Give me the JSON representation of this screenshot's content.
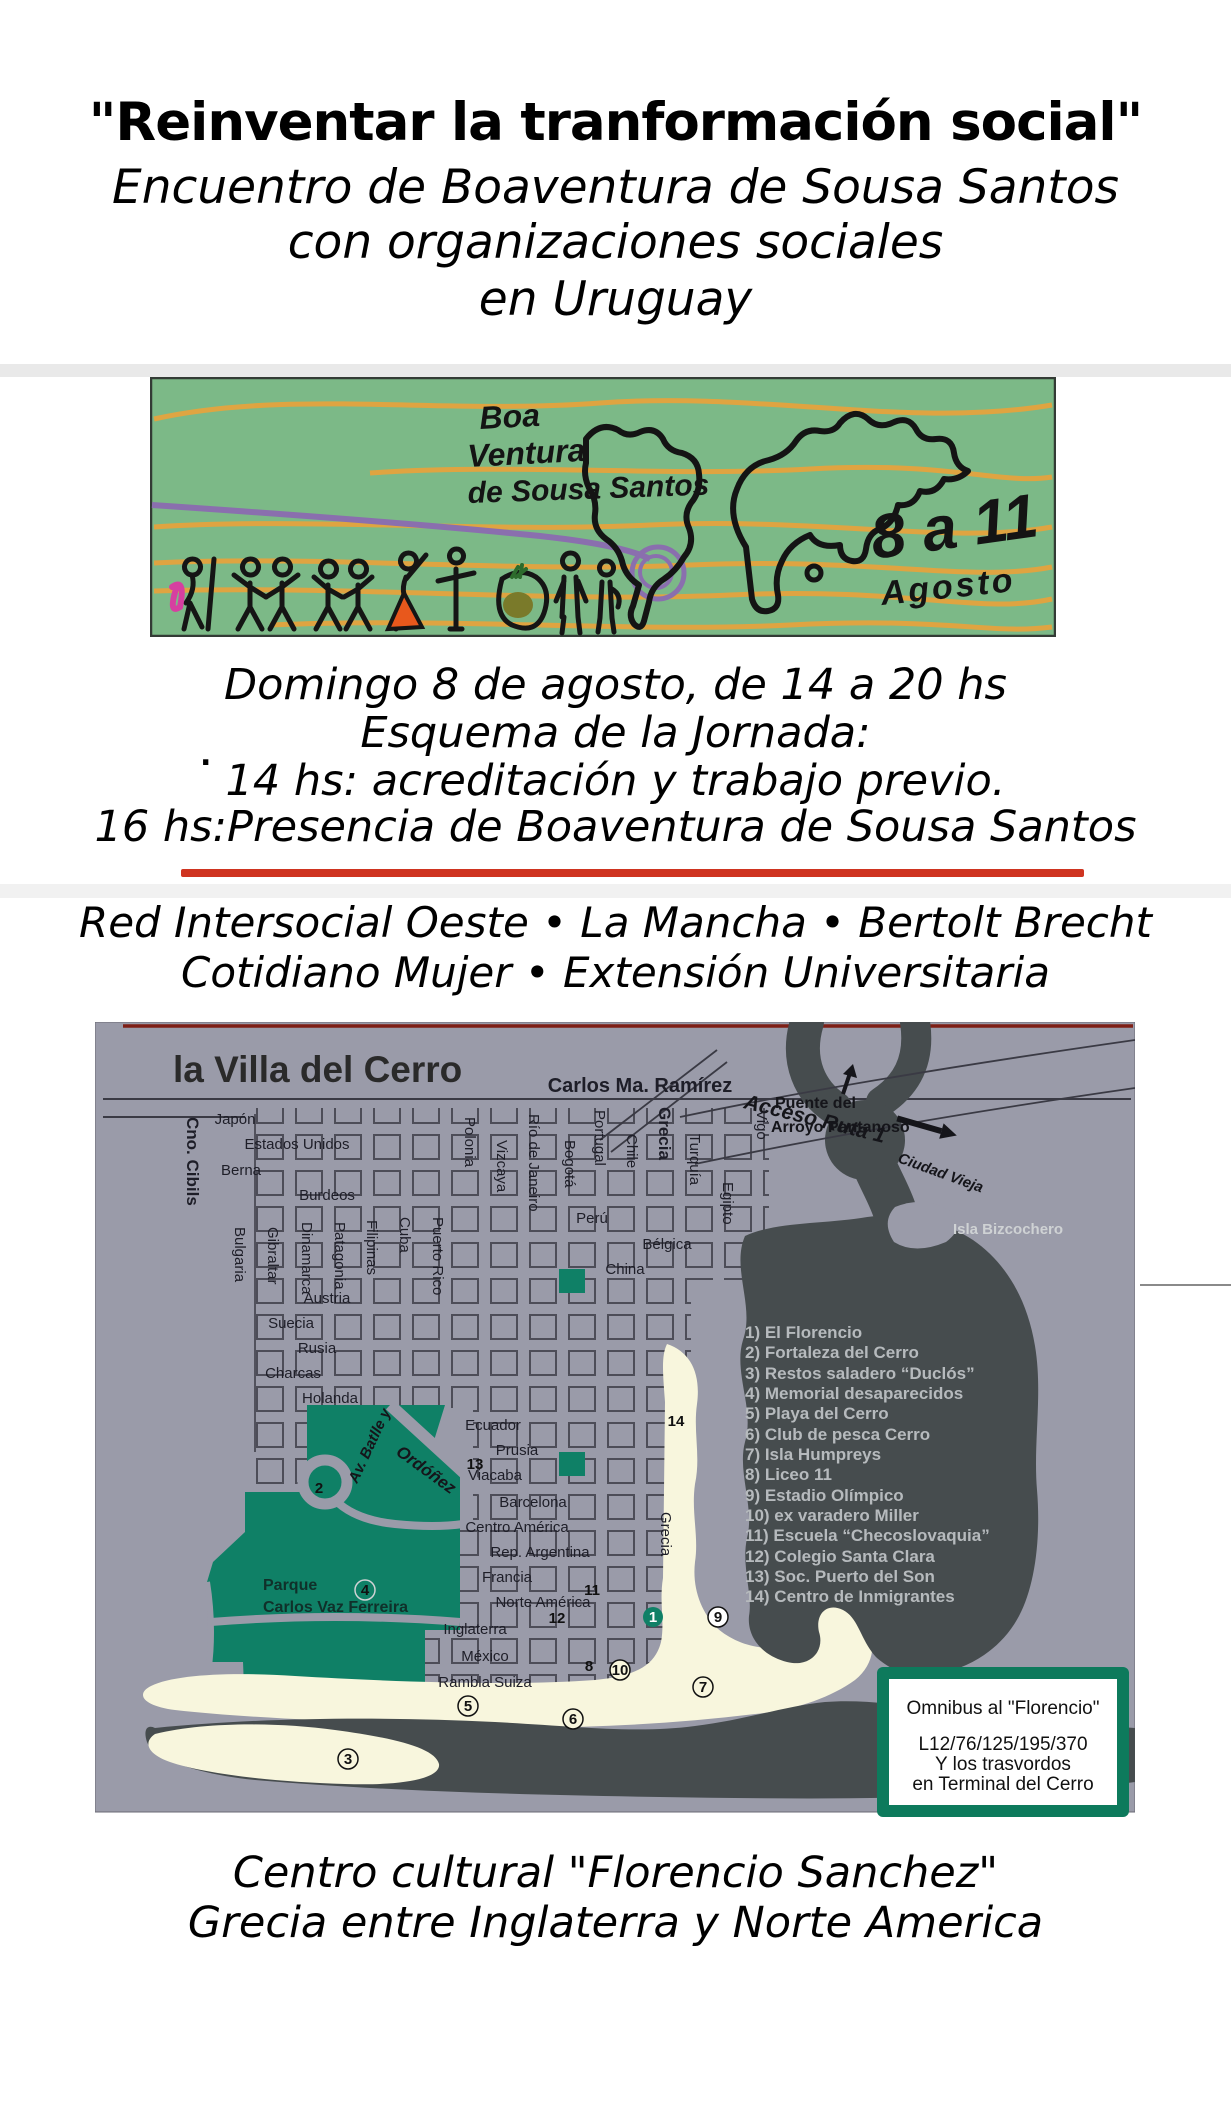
{
  "poster": {
    "title": "\"Reinventar la tranformación social\"",
    "subtitle": [
      "Encuentro de Boaventura de Sousa Santos",
      "con organizaciones sociales",
      "en Uruguay"
    ],
    "schedule": [
      "Domingo 8 de agosto, de 14 a 20 hs",
      "Esquema de la Jornada:",
      "14 hs: acreditación y trabajo previo.",
      "16 hs:Presencia de Boaventura de Sousa Santos"
    ],
    "stray_dot": ".",
    "orgs": [
      "Red Intersocial Oeste • La Mancha • Bertolt Brecht",
      "Cotidiano Mujer • Extensión Universitaria"
    ],
    "venue": [
      "Centro cultural \"Florencio Sanchez\"",
      "Grecia entre Inglaterra y Norte America"
    ],
    "banner": {
      "name": [
        "Boa",
        "Ventura",
        "de Sousa Santos"
      ],
      "dates": [
        "8 a 11",
        "Agosto"
      ]
    }
  },
  "map": {
    "title": "la Villa del Cerro",
    "streets_h": [
      "Carlos Ma. Ramírez",
      "Japón",
      "Estados Unidos",
      "Berna",
      "Burdeos",
      "Perú",
      "Bélgica",
      "China",
      "Austria",
      "Suecia",
      "Rusia",
      "Charcas",
      "Holanda",
      "Ecuador",
      "Prusia",
      "Viacaba",
      "Barcelona",
      "Centro América",
      "Rep. Argentina",
      "Francia",
      "Norte América",
      "Inglaterra",
      "México",
      "Rambla Suiza"
    ],
    "streets_v": [
      "Cno. Cibils",
      "Bulgaria",
      "Gibraltar",
      "Dinamarca",
      "Patagonia",
      "Filipinas",
      "Cuba",
      "Puerto Rico",
      "Polonia",
      "Vizcaya",
      "Río de Janeiro",
      "Bogotá",
      "Portugal",
      "Chile",
      "Grecia",
      "Turquía",
      "Egipto",
      "Vigo",
      "Grecia"
    ],
    "labels": {
      "acceso": "Acceso Ruta 1",
      "ciudad": "Ciudad Vieja",
      "puente1": "Puente del",
      "puente2": "Arroyo Pantanoso",
      "isla": "Isla Bizcochero",
      "parque1": "Parque",
      "parque2": "Carlos Vaz Ferreira",
      "av1": "Av. Batlle y",
      "av2": "Ordóñez"
    },
    "legend": [
      "1) El Florencio",
      "2) Fortaleza del Cerro",
      "3) Restos saladero “Duclós”",
      "4) Memorial desaparecidos",
      "5) Playa del Cerro",
      "6) Club de pesca Cerro",
      "7) Isla Humpreys",
      "8) Liceo 11",
      "9) Estadio Olímpico",
      "10) ex varadero Miller",
      "11) Escuela “Checoslovaquia”",
      "12) Colegio Santa Clara",
      "13) Soc. Puerto del Son",
      "14) Centro de Inmigrantes"
    ],
    "markers": [
      "1",
      "2",
      "3",
      "4",
      "5",
      "6",
      "7",
      "8",
      "9",
      "10",
      "11",
      "12",
      "13",
      "14"
    ],
    "bus_box": [
      "Omnibus al \"Florencio\"",
      "L12/76/125/195/370",
      "Y los trasvordos",
      "en Terminal del Cerro"
    ]
  },
  "colors": {
    "accent_red": "#cf3420",
    "map_bg": "#9a9ba9",
    "water": "#464c4e",
    "beach": "#f8f6dd",
    "park_green": "#0f8066",
    "banner_green": "#7cb987",
    "banner_orange": "#e5a33e",
    "banner_purple": "#8a6fae",
    "legend_text": "#b6babd",
    "bus_border": "#0d7a5c"
  }
}
